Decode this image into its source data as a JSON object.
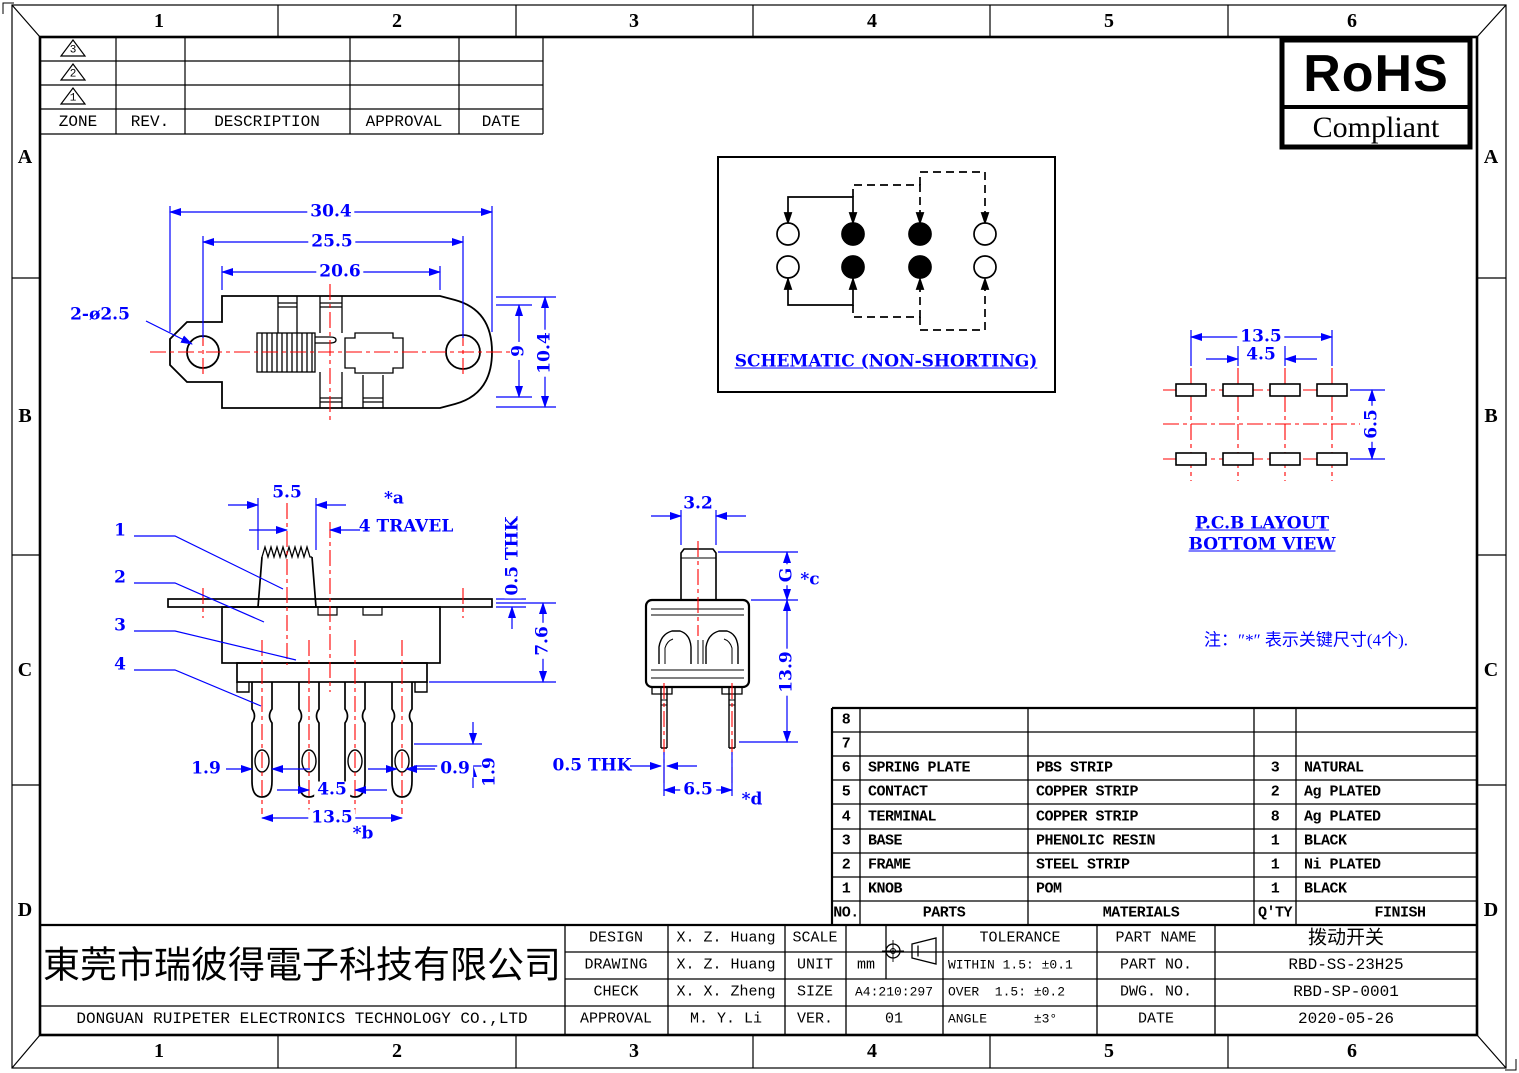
{
  "colors": {
    "dimension_blue": "#0000ff",
    "centerline_red": "#ff0000",
    "line_black": "#000000"
  },
  "drawing_border": {
    "column_labels": [
      "1",
      "2",
      "3",
      "4",
      "5",
      "6"
    ],
    "row_labels": [
      "A",
      "B",
      "C",
      "D"
    ]
  },
  "revision_table": {
    "marker_3": "3",
    "marker_2": "2",
    "marker_1": "1",
    "col_zone": "ZONE",
    "col_rev": "REV.",
    "col_description": "DESCRIPTION",
    "col_approval": "APPROVAL",
    "col_date": "DATE"
  },
  "rohs": {
    "title": "RoHS",
    "subtitle": "Compliant"
  },
  "top_view": {
    "dim_width_overall": "30.4",
    "dim_hole_span": "25.5",
    "dim_body_width": "20.6",
    "dim_holes": "2-ø2.5",
    "dim_height_inner": "9",
    "dim_height_overall": "10.4"
  },
  "schematic": {
    "title": "SCHEMATIC (NON-SHORTING)"
  },
  "pcb_layout": {
    "dim_span": "13.5",
    "dim_pitch": "4.5",
    "dim_row": "6.5",
    "title_line1": "P.C.B LAYOUT",
    "title_line2": "BOTTOM VIEW"
  },
  "front_view": {
    "callout_1": "1",
    "callout_2": "2",
    "callout_3": "3",
    "callout_4": "4",
    "dim_knob": "5.5",
    "key_a": "*a",
    "dim_travel": "4 TRAVEL",
    "dim_plate_thk": "0.5 THK",
    "dim_body_h": "7.6",
    "dim_term_w": "1.9",
    "dim_pitch": "4.5",
    "dim_span": "13.5",
    "key_b": "*b",
    "dim_slot": "0.9",
    "dim_hole": "1.9"
  },
  "side_view": {
    "dim_knob": "3.2",
    "dim_g": "G",
    "key_c": "*c",
    "dim_height": "13.9",
    "dim_thk": "0.5 THK",
    "dim_pitch": "6.5",
    "key_d": "*d"
  },
  "note": "注：″*″ 表示关键尺寸(4个).",
  "bom": {
    "headers": {
      "no": "NO.",
      "parts": "PARTS",
      "materials": "MATERIALS",
      "qty": "Q'TY",
      "finish": "FINISH"
    },
    "rows": [
      {
        "no": "8",
        "parts": "",
        "materials": "",
        "qty": "",
        "finish": ""
      },
      {
        "no": "7",
        "parts": "",
        "materials": "",
        "qty": "",
        "finish": ""
      },
      {
        "no": "6",
        "parts": "SPRING PLATE",
        "materials": "PBS STRIP",
        "qty": "3",
        "finish": "NATURAL"
      },
      {
        "no": "5",
        "parts": "CONTACT",
        "materials": "COPPER STRIP",
        "qty": "2",
        "finish": "Ag PLATED"
      },
      {
        "no": "4",
        "parts": "TERMINAL",
        "materials": "COPPER STRIP",
        "qty": "8",
        "finish": "Ag PLATED"
      },
      {
        "no": "3",
        "parts": "BASE",
        "materials": "PHENOLIC RESIN",
        "qty": "1",
        "finish": "BLACK"
      },
      {
        "no": "2",
        "parts": "FRAME",
        "materials": "STEEL STRIP",
        "qty": "1",
        "finish": "Ni PLATED"
      },
      {
        "no": "1",
        "parts": "KNOB",
        "materials": "POM",
        "qty": "1",
        "finish": "BLACK"
      }
    ]
  },
  "title_block": {
    "company_cn": "東莞市瑞彼得電子科技有限公司",
    "company_en": "DONGUAN RUIPETER ELECTRONICS TECHNOLOGY CO.,LTD",
    "design_label": "DESIGN",
    "design_value": "X. Z. Huang",
    "drawing_label": "DRAWING",
    "drawing_value": "X. Z. Huang",
    "check_label": "CHECK",
    "check_value": "X. X. Zheng",
    "approval_label": "APPROVAL",
    "approval_value": "M. Y. Li",
    "scale_label": "SCALE",
    "scale_value": "",
    "unit_label": "UNIT",
    "unit_value": "mm",
    "size_label": "SIZE",
    "size_value": "A4:210:297",
    "ver_label": "VER.",
    "ver_value": "01",
    "tolerance_title": "TOLERANCE",
    "tol_within": "WITHIN 1.5: ±0.1",
    "tol_over": "OVER  1.5: ±0.2",
    "tol_angle": "ANGLE      ±3°",
    "part_name_label": "PART NAME",
    "part_name_value": "拨动开关",
    "part_no_label": "PART NO.",
    "part_no_value": "RBD-SS-23H25",
    "dwg_no_label": "DWG. NO.",
    "dwg_no_value": "RBD-SP-0001",
    "date_label": "DATE",
    "date_value": "2020-05-26"
  }
}
